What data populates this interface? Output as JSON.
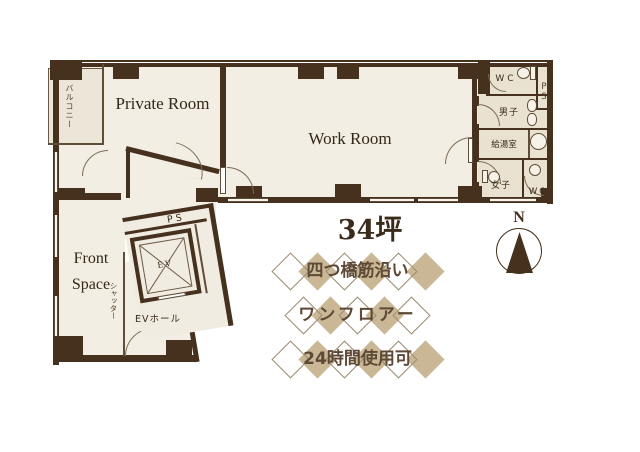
{
  "plan": {
    "rooms": {
      "private_room": "Private Room",
      "work_room": "Work Room",
      "front_line1": "Front",
      "front_line2": "Space",
      "balcony": "バルコニー",
      "shutter": "シャッター",
      "ps_elevator": "PS",
      "ev": "EV",
      "ev_hall": "EVホール",
      "wc_top": "WC",
      "ps_duct": "PS",
      "mens": "男子",
      "kitchenette": "給湯室",
      "womens": "女子",
      "wc_bottom": "WC"
    }
  },
  "area_label": "34坪",
  "banners": [
    {
      "text": "四つ橋筋沿い",
      "diamonds": 6
    },
    {
      "text": "ワンフロアー",
      "diamonds": 5
    },
    {
      "text": "24時間使用可",
      "diamonds": 6
    }
  ],
  "compass": {
    "label": "N"
  },
  "colors": {
    "wall": "#46301e",
    "floor": "#f3eee3",
    "facility_floor": "#eae2d1",
    "diamond_fill": "#c9b795",
    "diamond_outline": "#9c8b71",
    "banner_text": "#5d4936"
  }
}
